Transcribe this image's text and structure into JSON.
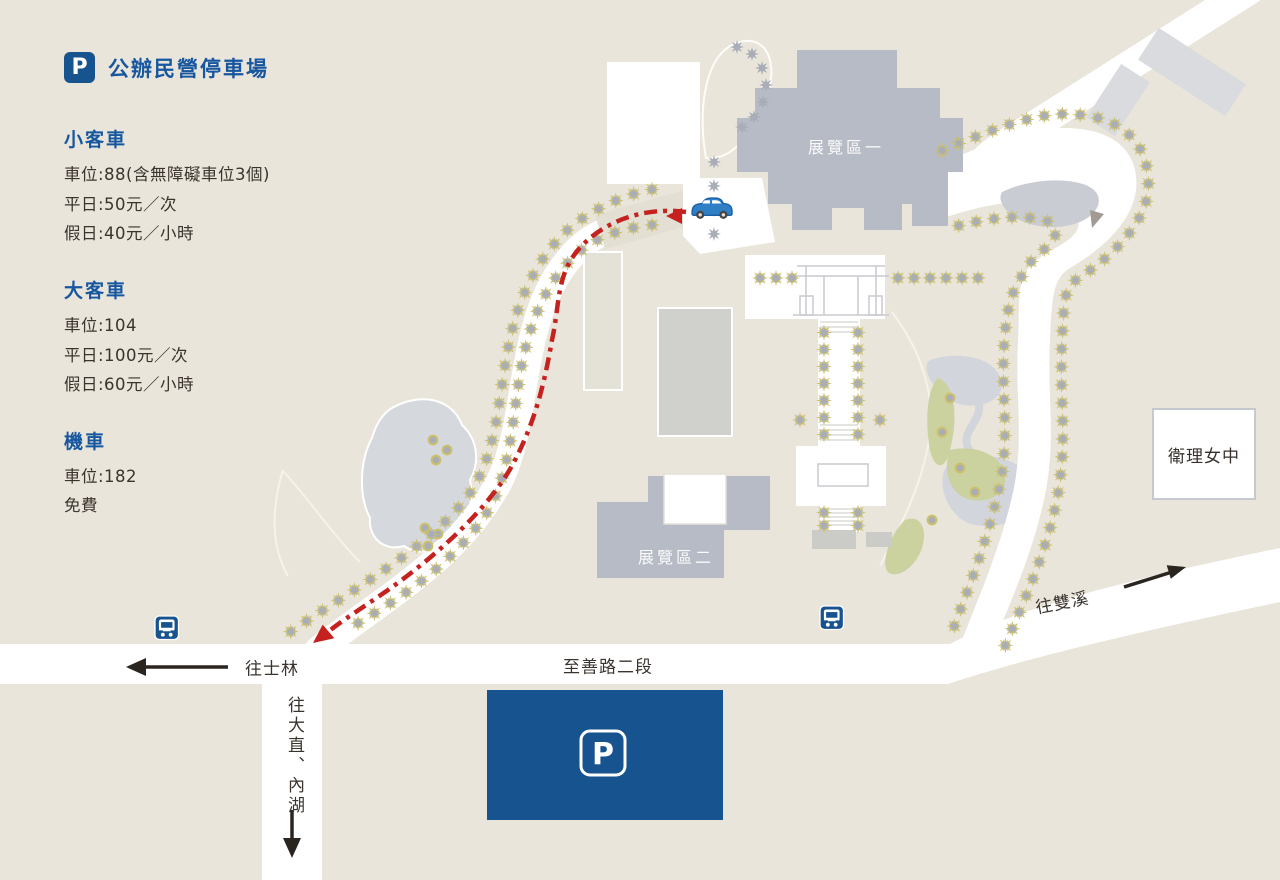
{
  "legend": {
    "badge_letter": "P",
    "title": "公辦民營停車場",
    "sections": [
      {
        "heading": "小客車",
        "lines": [
          "車位:88(含無障礙車位3個)",
          "平日:50元／次",
          "假日:40元／小時"
        ]
      },
      {
        "heading": "大客車",
        "lines": [
          "車位:104",
          "平日:100元／次",
          "假日:60元／小時"
        ]
      },
      {
        "heading": "機車",
        "lines": [
          "車位:182",
          "免費"
        ]
      }
    ]
  },
  "map": {
    "exhibition_area_1": "展覽區一",
    "exhibition_area_2": "展覽區二",
    "school": "衛理女中",
    "road_zhishan": "至善路二段",
    "dir_shilin": "往士林",
    "dir_shuangxi": "往雙溪",
    "dir_dazhi_neihu": "往大直、內湖",
    "parking_sign_letter": "P",
    "icons": {
      "parking_badge": "p-badge-icon",
      "parking_sign": "p-sign-icon",
      "bus_stop": "bus-stop-icon",
      "car": "car-icon",
      "route": "red-dashed-route"
    },
    "colors": {
      "brand_blue": "#17538e",
      "route_red": "#c5221f",
      "building_gray": "#b6bbc5",
      "tree_olive": "#cdc069",
      "tree_gray": "#a8adb8",
      "background": "#e9e5da"
    }
  }
}
